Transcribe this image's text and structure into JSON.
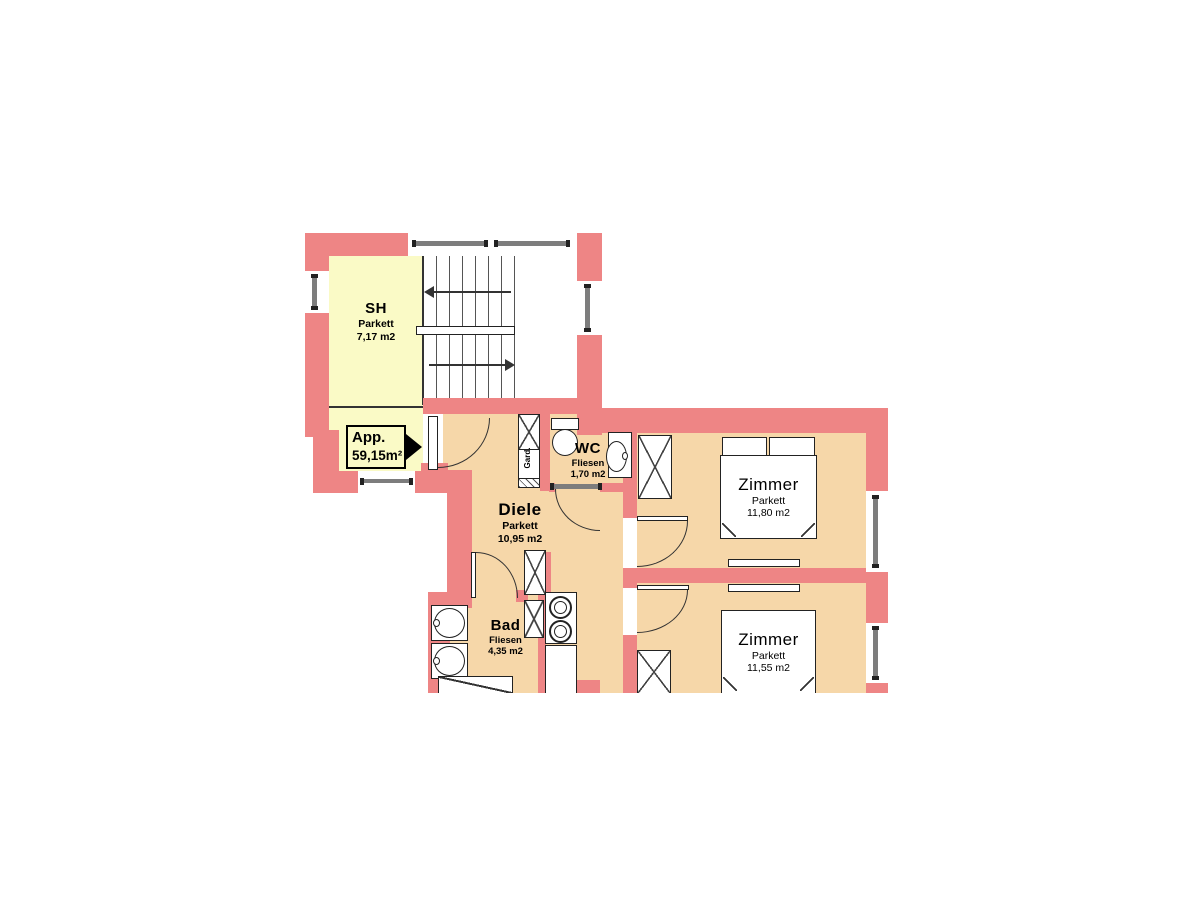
{
  "plan": {
    "apartment_label": {
      "name": "App.",
      "area": "59,15m²"
    },
    "rooms": [
      {
        "name": "SH",
        "floor": "Parkett",
        "area": "7,17 m2"
      },
      {
        "name": "Diele",
        "floor": "Parkett",
        "area": "10,95 m2"
      },
      {
        "name": "WC",
        "floor": "Fliesen",
        "area": "1,70 m2"
      },
      {
        "name": "Bad",
        "floor": "Fliesen",
        "area": "4,35 m2"
      },
      {
        "name": "Zimmer",
        "floor": "Parkett",
        "area": "11,80 m2"
      },
      {
        "name": "Zimmer",
        "floor": "Parkett",
        "area": "11,55 m2"
      }
    ],
    "closet_label": "Gard.",
    "colors": {
      "wall": "#ee8585",
      "room_floor": "#f6d7a9",
      "sh_floor": "#fafac6",
      "line": "#333333"
    }
  }
}
